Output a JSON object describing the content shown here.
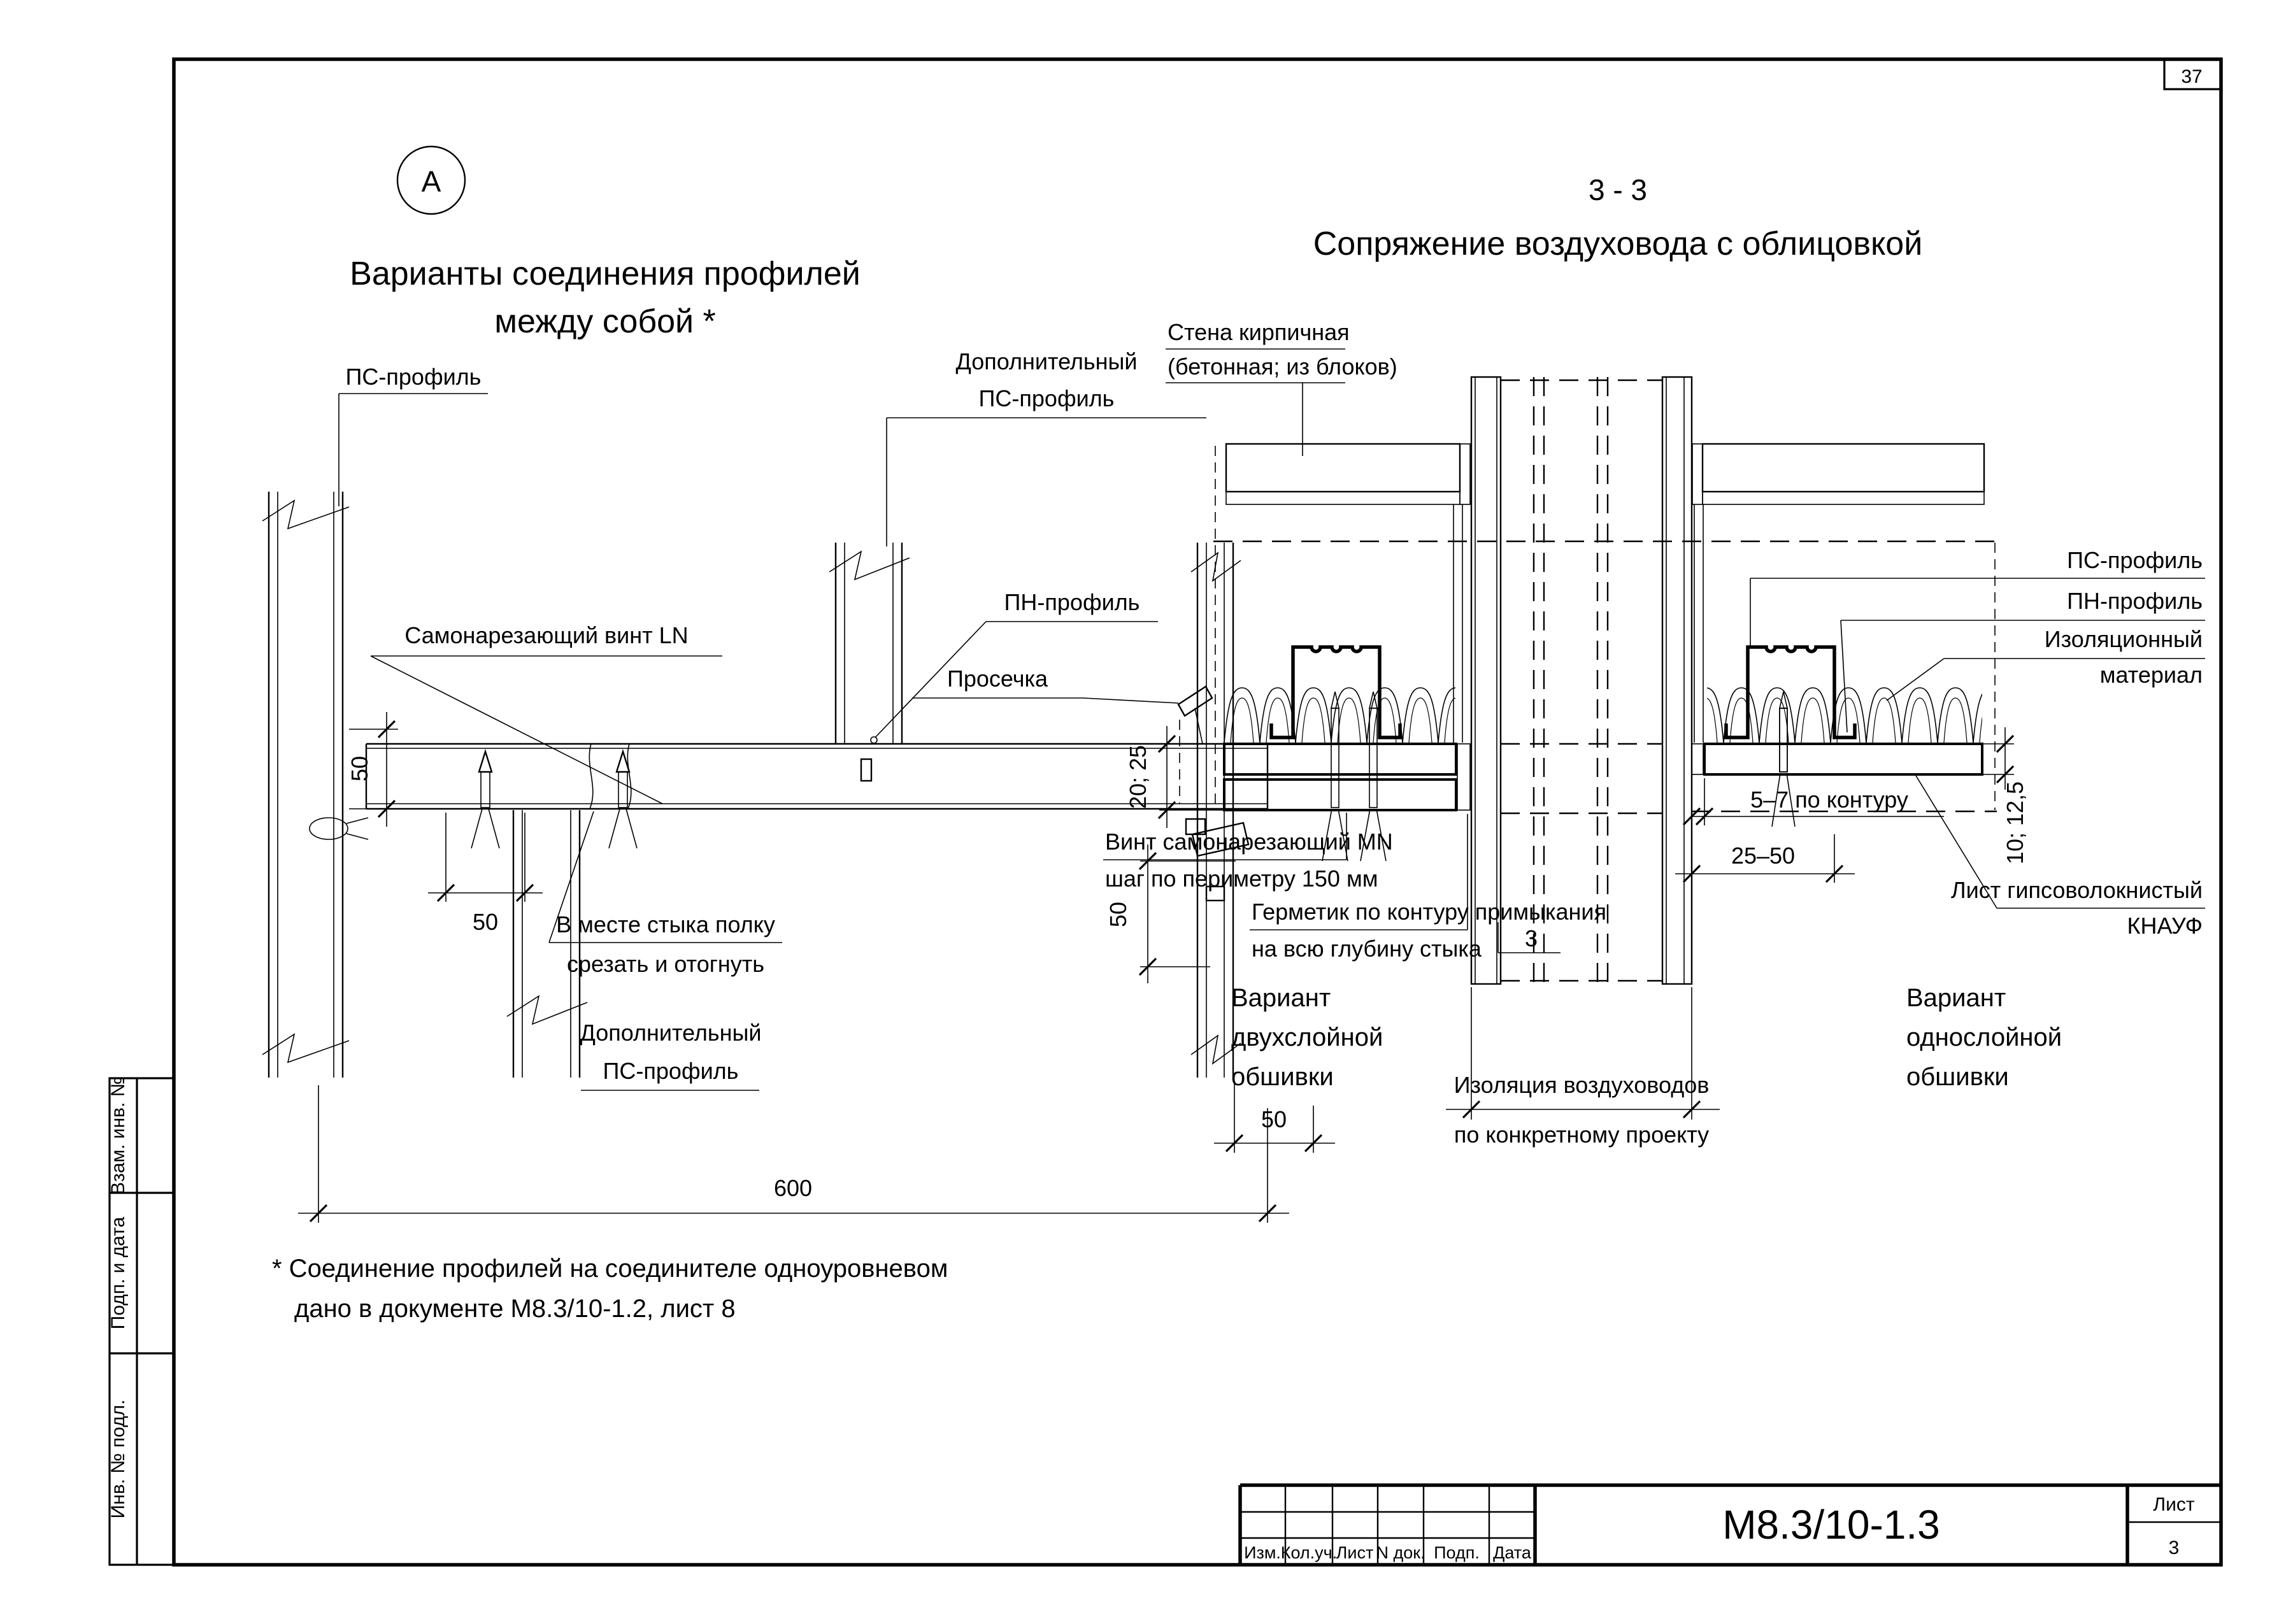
{
  "page": {
    "number": "37"
  },
  "detail_a": {
    "mark": "А",
    "title_line1": "Варианты соединения профилей",
    "title_line2": "между собой *",
    "labels": {
      "ps_top": "ПС-профиль",
      "dop_top_line1": "Дополнительный",
      "dop_top_line2": "ПС-профиль",
      "screw": "Самонарезающий винт LN",
      "pn": "ПН-профиль",
      "prosechka": "Просечка",
      "cut_line1": "В месте стыка полку",
      "cut_line2": "срезать и отогнуть",
      "dop_bottom_line1": "Дополнительный",
      "dop_bottom_line2": "ПС-профиль"
    },
    "dims": {
      "d50_left": "50",
      "d50_mid": "50",
      "d50_right": "50",
      "d50_bottom": "50",
      "d600": "600"
    },
    "footnote_line1": "*  Соединение профилей на соединителе одноуровневом",
    "footnote_line2": "дано в документе М8.3/10-1.2, лист 8"
  },
  "section_33": {
    "mark": "3 - 3",
    "title": "Сопряжение воздуховода с облицовкой",
    "labels": {
      "wall_line1": "Стена кирпичная",
      "wall_line2": "(бетонная; из блоков)",
      "ps": "ПС-профиль",
      "pn": "ПН-профиль",
      "insul_line1": "Изоляционный",
      "insul_line2": "материал",
      "screw_line1": "Винт самонарезающий MN",
      "screw_line2": "шаг по периметру 150 мм",
      "sealant_line1": "Герметик по контуру примыкания",
      "sealant_line2": "на всю глубину стыка",
      "gvl_line1": "Лист гипсоволокнистый",
      "gvl_line2": "КНАУФ",
      "duct_ins_line1": "Изоляция воздуховодов",
      "duct_ins_line2": "по конкретному проекту",
      "variant2_line1": "Вариант",
      "variant2_line2": "двухслойной",
      "variant2_line3": "обшивки",
      "variant1_line1": "Вариант",
      "variant1_line2": "однослойной",
      "variant1_line3": "обшивки"
    },
    "dims": {
      "d2025": "20; 25",
      "d1012": "10; 12,5",
      "d57": "5–7 по контуру",
      "d2550": "25–50",
      "callout3": "3"
    }
  },
  "stamp": {
    "doc_number": "М8.3/10-1.3",
    "sheet_label": "Лист",
    "sheet_number": "3",
    "columns": [
      "Изм.",
      "Кол.уч.",
      "Лист",
      "N док.",
      "Подп.",
      "Дата"
    ],
    "sidebar": [
      "Взам. инв. №",
      "Подп. и дата",
      "Инв. № подл."
    ]
  },
  "colors": {
    "board_blue": "#b9d5e8",
    "line": "#000000"
  }
}
